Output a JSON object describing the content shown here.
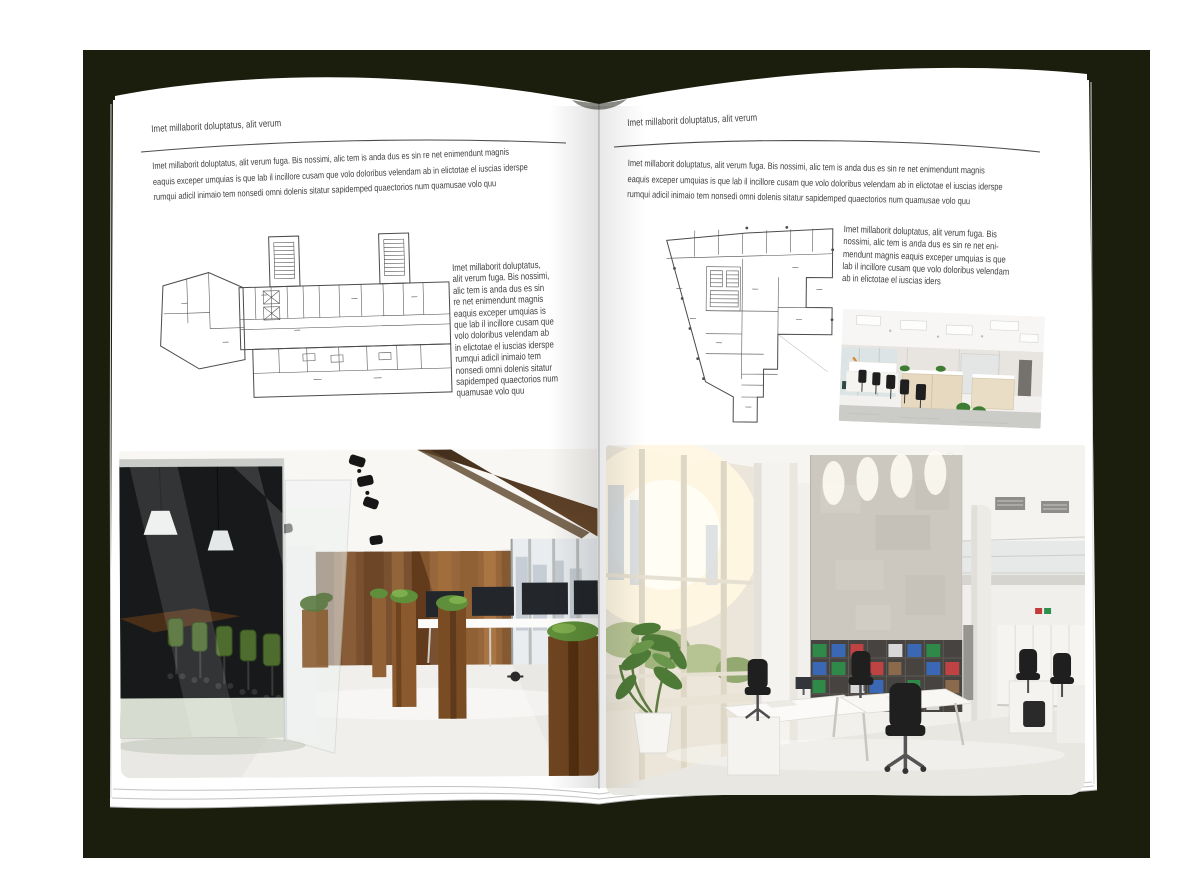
{
  "scene": {
    "type": "open-brochure-mockup",
    "colors": {
      "backdrop": "#1b1e0c",
      "paper": "#ffffff",
      "text": "#3f3f3f",
      "rule": "#4c4c4c",
      "wood_wall": "#7a5130",
      "meeting_chair_green": "#4d6c2e",
      "plant_green": "#4e7a38"
    }
  },
  "left_page": {
    "header": "Imet millaborit doluptatus, alit verum",
    "intro": "Imet millaborit doluptatus, alit verum fuga. Bis nossimi, alic tem is anda dus es sin re net enimendunt magnis\neaquis exceper umquias is que lab il incillore cusam que volo doloribus velendam ab in elictotae el iuscias iderspe\nrumqui adicil inimaio tem nonsedi omni dolenis sitatur sapidemped quaectorios num quamusae volo quu",
    "side_text": "Imet millaborit doluptatus,\nalit verum fuga. Bis nossimi,\nalic tem is anda dus es sin\nre net enimendunt magnis\neaquis exceper umquias is\nque lab il incillore cusam que\nvolo doloribus velendam ab\nin elictotae el iuscias iderspe\nrumqui adicil inimaio tem\nnonsedi omni dolenis sitatur\nsapidemped quaectorios num\nquamusae volo quu",
    "floor_plan": "wide-building-floor-plan-with-two-stair-towers",
    "photo": "office-interior-dark-wood-wall-glass-meeting-room-green-chairs"
  },
  "right_page": {
    "header": "Imet millaborit doluptatus, alit verum",
    "intro": "Imet millaborit doluptatus, alit verum fuga. Bis nossimi, alic tem is anda dus es sin re net enimendunt magnis\neaquis exceper umquias is que lab il incillore cusam que volo doloribus velendam ab in elictotae el iuscias iderspe\nrumqui adicil inimaio tem nonsedi omni dolenis sitatur sapidemped quaectorios num quamusae volo quu",
    "side_text": "Imet millaborit doluptatus, alit verum fuga. Bis\nnossimi, alic tem is anda dus es sin re net eni-\nmendunt magnis eaquis exceper umquias is que\nlab il incillore cusam que volo doloribus velendam\nab in elictotae el iuscias iders",
    "floor_plan": "irregular-building-floor-plan",
    "photo_small": "white-open-space-office-workstations",
    "photo_large": "bright-double-height-office-concrete-wall-bookshelves"
  }
}
